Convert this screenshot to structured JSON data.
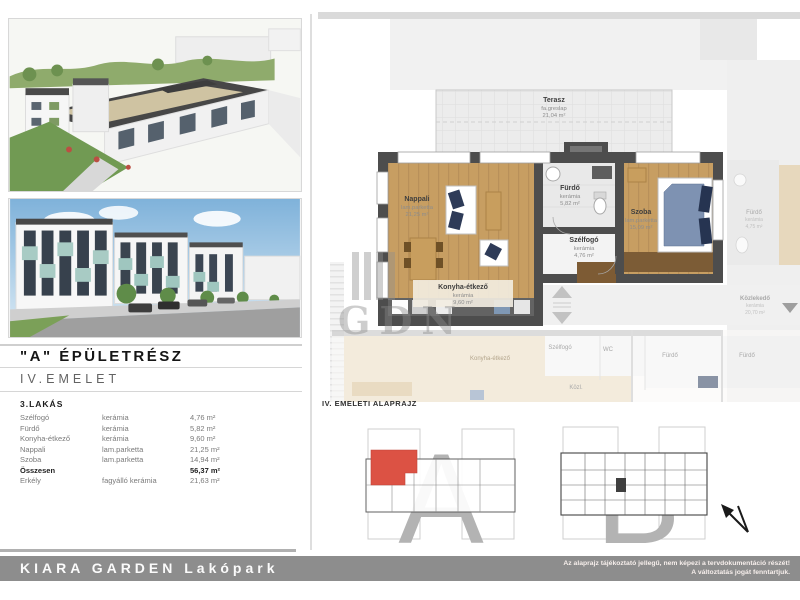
{
  "left_panel": {
    "building_title": "\"A\" ÉPÜLETRÉSZ",
    "floor_title": "IV.EMELET",
    "apartment_title": "3.LAKÁS",
    "room_table": {
      "rows": [
        {
          "name": "Szélfogó",
          "material": "kerámia",
          "area": "4,76 m²"
        },
        {
          "name": "Fürdő",
          "material": "kerámia",
          "area": "5,82 m²"
        },
        {
          "name": "Konyha-étkező",
          "material": "kerámia",
          "area": "9,60 m²"
        },
        {
          "name": "Nappali",
          "material": "lam.parketta",
          "area": "21,25 m²"
        },
        {
          "name": "Szoba",
          "material": "lam.parketta",
          "area": "14,94 m²"
        },
        {
          "name": "Összesen",
          "material": "",
          "area": "56,37 m²"
        },
        {
          "name": "Erkély",
          "material": "fagyálló kerámia",
          "area": "21,63 m²"
        }
      ]
    }
  },
  "floorplan": {
    "terrace": {
      "name": "Terasz",
      "material": "fa.greslap",
      "area": "21,04 m²"
    },
    "rooms": {
      "nappali": {
        "name": "Nappali",
        "material": "lam.parketta",
        "area": "21,25 m²"
      },
      "furdo": {
        "name": "Fürdő",
        "material": "kerámia",
        "area": "5,82 m²"
      },
      "szoba": {
        "name": "Szoba",
        "material": "lam.parketta",
        "area": "15,09 m²"
      },
      "szelfogo": {
        "name": "Szélfogó",
        "material": "kerámia",
        "area": "4,76 m²"
      },
      "konyha": {
        "name": "Konyha-étkező",
        "material": "kerámia",
        "area": "9,60 m²"
      }
    },
    "neighbors": {
      "furdo_right": {
        "name": "Fürdő",
        "material": "kerámia",
        "area": "4,75 m²"
      },
      "kozlekedo": {
        "name": "Közlekedő",
        "material": "kerámia",
        "area": "20,70 m²"
      },
      "szelfogo": "Szélfogó",
      "wc": "WC",
      "furdo_b1": "Fürdő",
      "furdo_b2": "Fürdő",
      "konyha": "Konyha-étkező",
      "kozl": "Közl."
    },
    "watermark": "GDN"
  },
  "keyplan": {
    "heading": "IV. EMELETI ALAPRAJZ",
    "section_a_letter": "A",
    "section_b_letter": "B"
  },
  "footer": {
    "brand": "KIARA GARDEN Lakópark",
    "disclaimer_line1": "Az alaprajz tájékoztató jellegű, nem képezi a tervdokumentáció részét!",
    "disclaimer_line2": "A változtatás jogát fenntartjuk."
  },
  "colors": {
    "wall": "#4d4d4d",
    "wood_floor": "#c79e62",
    "highlight_red": "#dc5244",
    "footer_bar": "#8d8d8d",
    "navy_textile": "#2e3b58",
    "tile": "#e9e9e9"
  }
}
